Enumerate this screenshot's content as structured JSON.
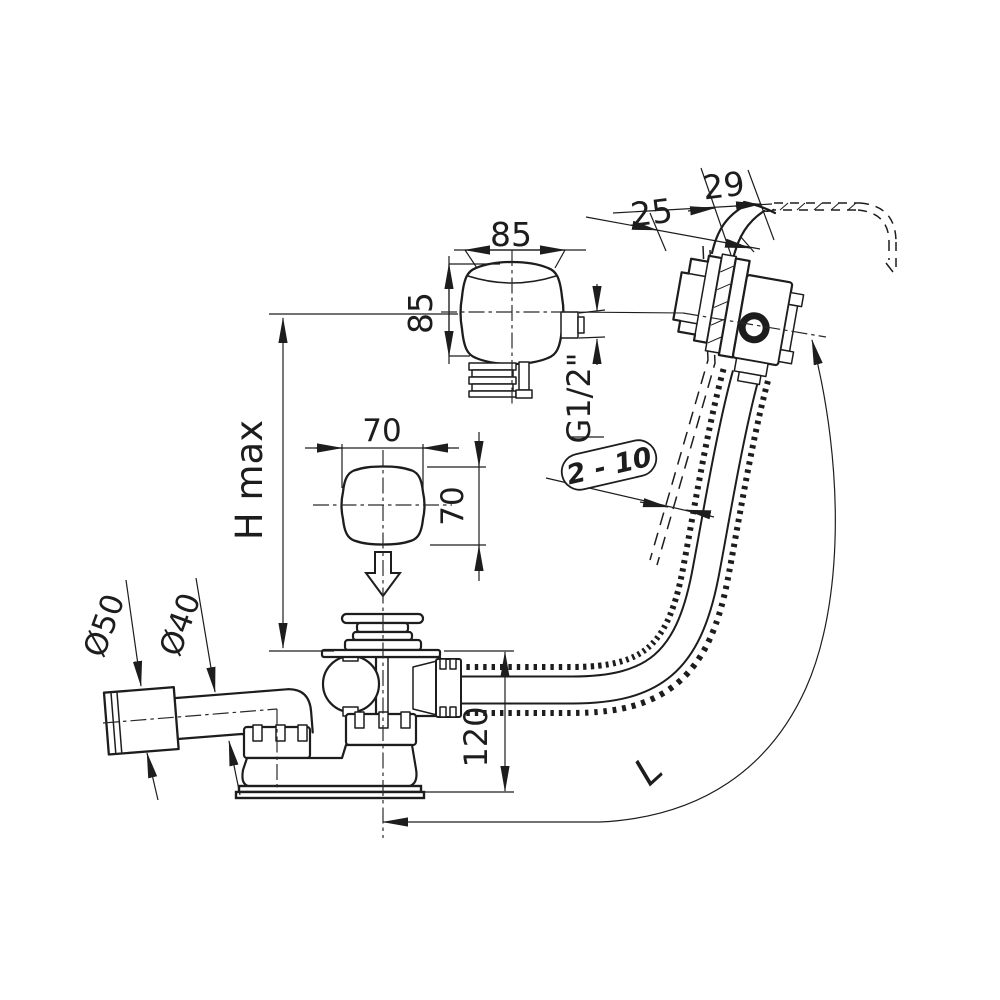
{
  "drawing": {
    "type": "technical-dimension-drawing",
    "subject": "bath waste, overflow and filler set with flexible hose - side view with dimensions",
    "background_color": "#ffffff",
    "line_color": "#1d1d1d",
    "labels": {
      "rim_width": "29",
      "rim_offset": "25",
      "overflow_knob_width": "85",
      "overflow_knob_height": "85",
      "thread_size": "G1/2\"",
      "wall_gap_range": "2 - 10",
      "cover_width": "70",
      "cover_height": "70",
      "max_height": "H max",
      "outlet_diameter": "Ø50",
      "pipe_diameter": "Ø40",
      "drain_body_height": "120",
      "hose_length": "L"
    }
  }
}
